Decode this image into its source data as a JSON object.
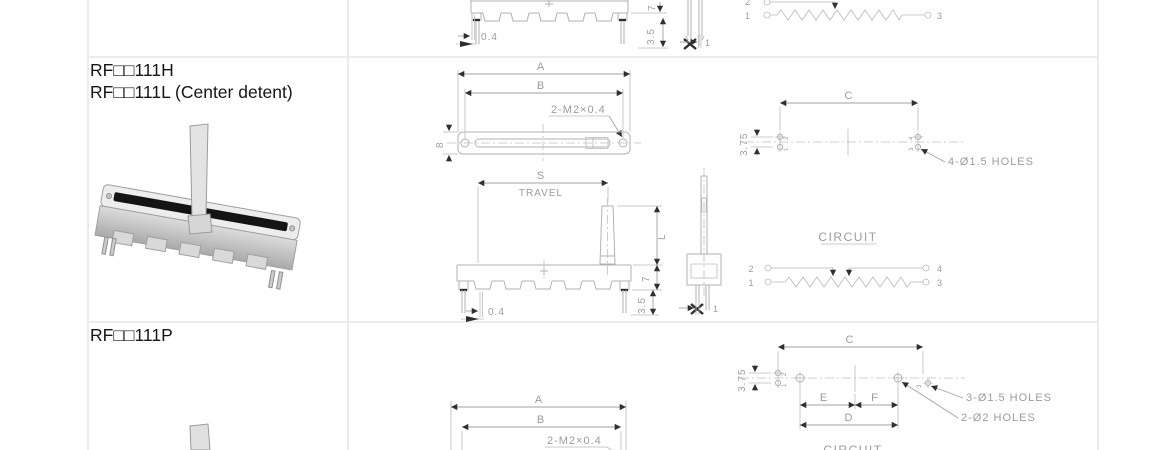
{
  "meta": {
    "bg": "#ffffff",
    "table_border_color": "#ececec",
    "drawing_line_color": "#b2b2b2",
    "drawing_text_color": "#9c9c9c",
    "arrow_color": "#2f2f2f",
    "title_color": "#161616"
  },
  "rows": [
    {
      "front_view": {
        "dim_04": "0.4",
        "dim_7": "7",
        "dim_35": "3.5"
      },
      "side_view": {
        "dim_1": "1"
      },
      "circuit": {
        "t2": "2",
        "t1": "1",
        "t3": "3"
      }
    },
    {
      "title_line1": "RF□□111H",
      "title_line2": "RF□□111L (Center detent)",
      "top_view": {
        "dim_a": "A",
        "dim_b": "B",
        "thread": "2-M2×0.4",
        "dim_8": "8"
      },
      "front_view": {
        "dim_s": "S",
        "travel": "TRAVEL",
        "dim_l": "L",
        "dim_7": "7",
        "dim_04": "0.4",
        "dim_35": "3.5"
      },
      "side_view": {
        "dim_1": "1"
      },
      "holes": {
        "dim_c": "C",
        "dim_375": "3.75",
        "label": "4-Ø1.5 HOLES",
        "pins": [
          "2",
          "1",
          "4",
          "3"
        ]
      },
      "circuit": {
        "title": "CIRCUIT",
        "t2": "2",
        "t4": "4",
        "t1": "1",
        "t3": "3"
      }
    },
    {
      "title_line1": "RF□□111P",
      "top_view": {
        "dim_a": "A",
        "dim_b": "B",
        "thread": "2-M2×0.4"
      },
      "holes": {
        "dim_c": "C",
        "dim_375": "3.75",
        "dim_e": "E",
        "dim_f": "F",
        "dim_d": "D",
        "label_small": "3-Ø1.5 HOLES",
        "label_big": "2-Ø2 HOLES",
        "pins": [
          "2",
          "1",
          "3"
        ]
      },
      "circuit": {
        "title": "CIRCUIT"
      }
    }
  ]
}
